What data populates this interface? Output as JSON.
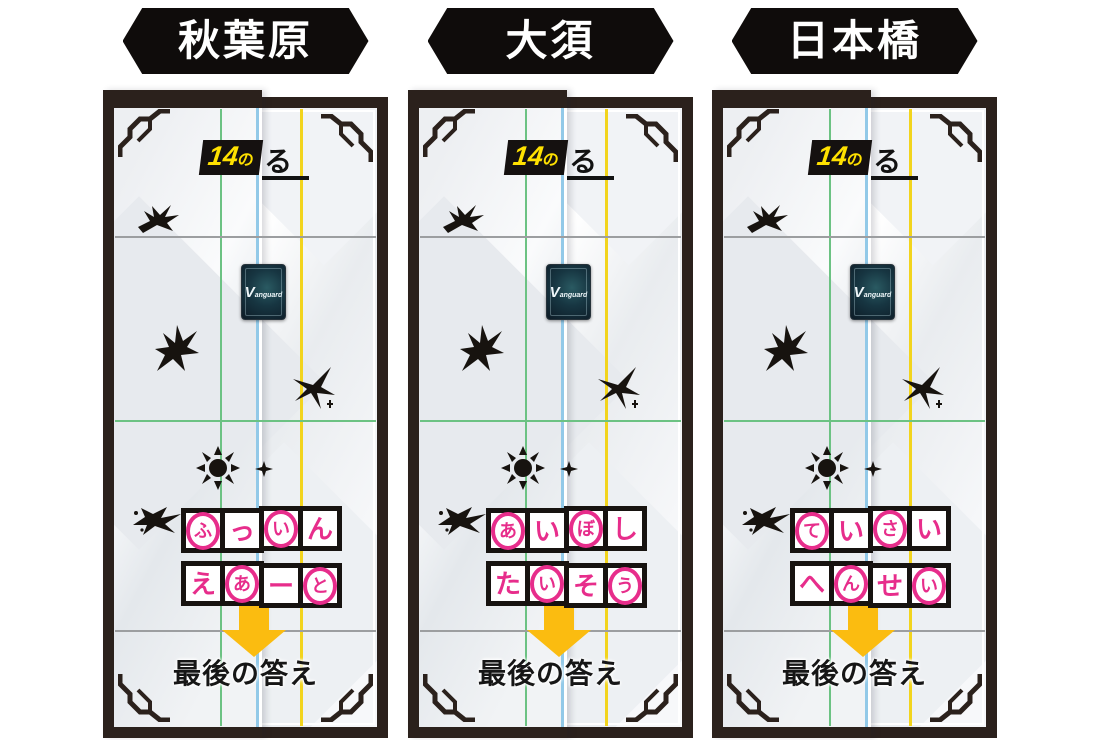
{
  "headers": [
    {
      "label": "秋葉原"
    },
    {
      "label": "大須"
    },
    {
      "label": "日本橋"
    }
  ],
  "mat": {
    "step_number": "14",
    "step_particle": "の",
    "step_kana": "る",
    "final_label": "最後の答え",
    "card_logo": "Vanguard"
  },
  "panels": [
    {
      "location": "秋葉原",
      "rows": [
        {
          "cells": [
            {
              "char": "ふ",
              "circled": "true"
            },
            {
              "char": "っ",
              "circled": "false"
            },
            {
              "char": "い",
              "circled": "true"
            },
            {
              "char": "ん",
              "circled": "false"
            }
          ]
        },
        {
          "cells": [
            {
              "char": "え",
              "circled": "false"
            },
            {
              "char": "あ",
              "circled": "true"
            },
            {
              "char": "ー",
              "circled": "false"
            },
            {
              "char": "と",
              "circled": "true"
            }
          ]
        }
      ]
    },
    {
      "location": "大須",
      "rows": [
        {
          "cells": [
            {
              "char": "あ",
              "circled": "true"
            },
            {
              "char": "い",
              "circled": "false"
            },
            {
              "char": "ぼ",
              "circled": "true"
            },
            {
              "char": "し",
              "circled": "false"
            }
          ]
        },
        {
          "cells": [
            {
              "char": "た",
              "circled": "false"
            },
            {
              "char": "い",
              "circled": "true"
            },
            {
              "char": "そ",
              "circled": "false"
            },
            {
              "char": "う",
              "circled": "true"
            }
          ]
        }
      ]
    },
    {
      "location": "日本橋",
      "rows": [
        {
          "cells": [
            {
              "char": "て",
              "circled": "true"
            },
            {
              "char": "い",
              "circled": "false"
            },
            {
              "char": "さ",
              "circled": "true"
            },
            {
              "char": "い",
              "circled": "false"
            }
          ]
        },
        {
          "cells": [
            {
              "char": "へ",
              "circled": "false"
            },
            {
              "char": "ん",
              "circled": "true"
            },
            {
              "char": "せ",
              "circled": "false"
            },
            {
              "char": "い",
              "circled": "true"
            }
          ]
        }
      ]
    }
  ],
  "icons": {
    "down_arrow": "down-arrow",
    "card_back": "vanguard-card-back",
    "corner_ornament": "corner-ornament",
    "emblems": [
      "emblem-branch",
      "emblem-flourish",
      "emblem-star",
      "emblem-sun",
      "emblem-bird",
      "emblem-spark"
    ]
  },
  "colors": {
    "banner_bg": "#0f0c0b",
    "banner_text": "#ffffff",
    "frame": "#2b211c",
    "ink": "#17130f",
    "line_green": "#6cc283",
    "line_blue": "#92c9e8",
    "line_yellow": "#f2d41d",
    "line_gray": "#9c9ea0",
    "accent_pink": "#e72d8b",
    "accent_yellow": "#ffe100",
    "arrow": "#fbbc10",
    "card_bg": "#101c26"
  }
}
